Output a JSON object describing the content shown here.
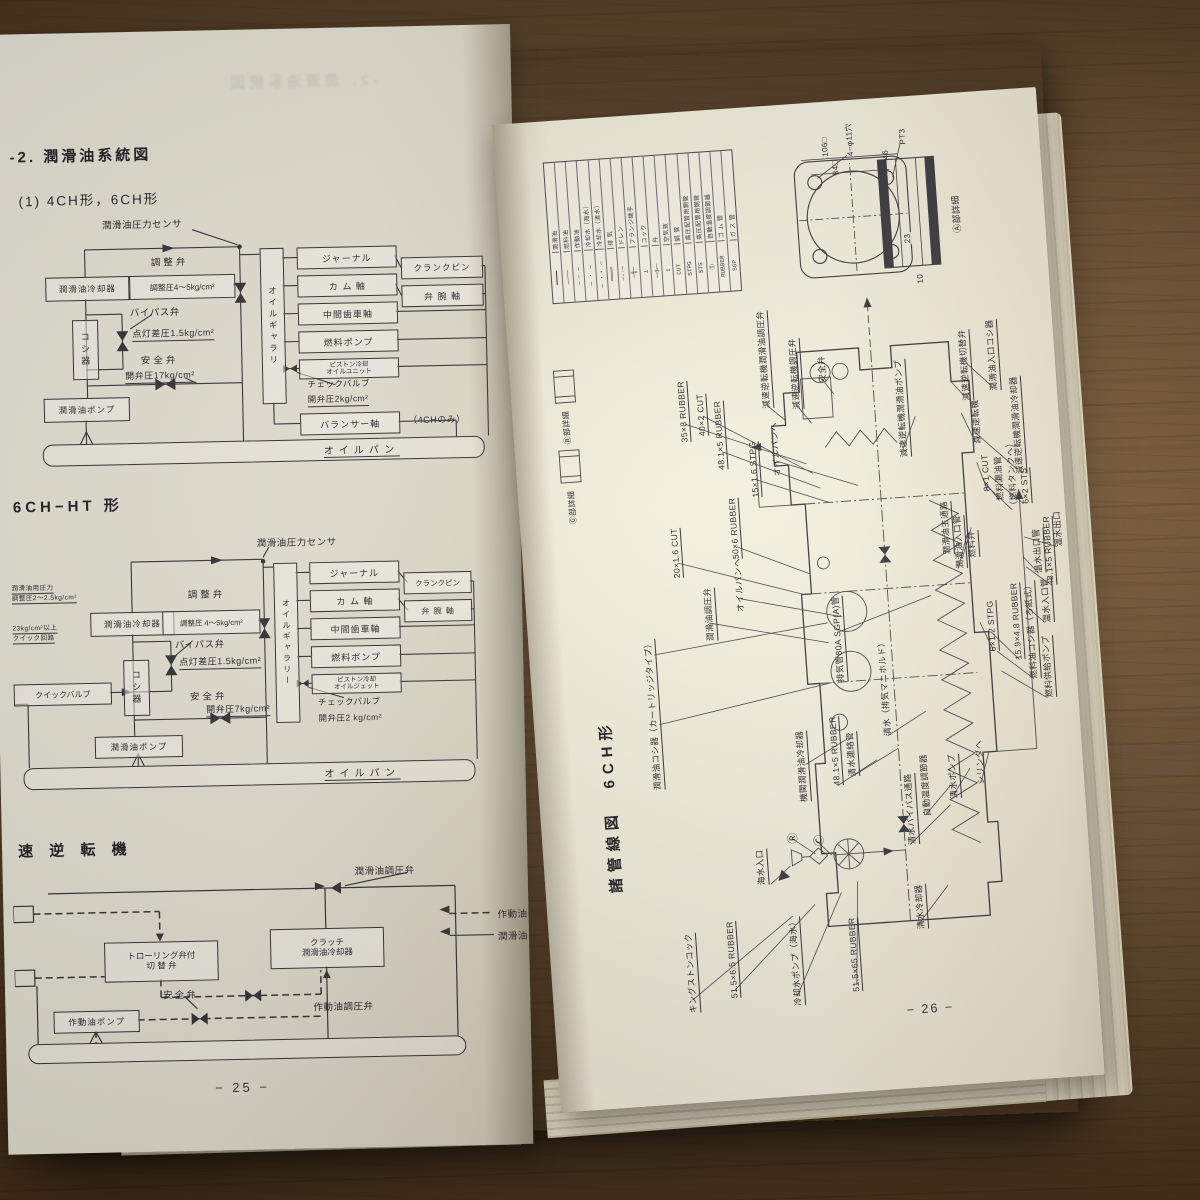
{
  "left_page": {
    "title": "-2. 潤滑油系統図",
    "subtitle": "(1) 4CH形，6CH形",
    "page_number": "− 25 −",
    "d1": {
      "sensor": "潤滑油圧力センサ",
      "cooler": "潤滑油冷却器",
      "reg_valve": "調整弁",
      "reg_pressure": "調整圧4〜5kg/cm²",
      "bypass": "バイパス弁",
      "strainer": "コシ器",
      "lamp_diff": "点灯差圧1.5kg/cm²",
      "safety": "安全弁",
      "open17": "開弁圧17kg/cm²",
      "pump": "潤滑油ポンプ",
      "gallery": "オイルギャラリ",
      "journal": "ジャーナル",
      "crankpin": "クランクピン",
      "cam": "カ ム 軸",
      "rocker": "弁 腕 軸",
      "idler": "中間歯車軸",
      "fuel_pump": "燃料ポンプ",
      "piston1": "ピストン冷却",
      "piston2": "オイルユニット",
      "check": "チェックバルブ",
      "open2": "開弁圧2kg/cm²",
      "balancer": "バランサー軸",
      "balancer_note": "（4CHのみ）",
      "pan": "オイルパン"
    },
    "d2_title": "6CH−HT 形",
    "d2": {
      "note1a": "潤滑油用圧力",
      "note1b": "調整圧2〜2.5kg/cm²",
      "note2a": "23kg/cm²以上",
      "note2b": "クイック回路",
      "quick_valve": "クイックバルブ",
      "sensor": "潤滑油圧力センサ",
      "cooler": "潤滑油冷却器",
      "reg_valve": "調整弁",
      "reg_pressure": "調整圧 4〜5kg/cm²",
      "bypass": "バイパス弁",
      "lamp_diff": "点灯差圧1.5kg/cm²",
      "strainer": "コシ器",
      "safety": "安全弁",
      "open7": "開弁圧7kg/cm²",
      "pump": "潤滑油ポンプ",
      "gallery": "オイルギャラリー",
      "journal": "ジャーナル",
      "crankpin": "クランクピン",
      "cam": "カ ム 軸",
      "rocker": "弁 腕 軸",
      "idler": "中間歯車軸",
      "fuel_pump": "燃料ポンプ",
      "piston1": "ピストン冷却",
      "piston2": "オイルジェット",
      "check": "チェックバルブ",
      "open2": "開弁圧2 kg/cm²",
      "pan": "オイルパン"
    },
    "d3_title": "速 逆 転 機",
    "d3": {
      "press_valve": "潤滑油調圧弁",
      "legend_working": "作動油",
      "legend_lube": "潤滑油",
      "trolling1": "トローリング弁付",
      "trolling2": "切 替 弁",
      "clutch1": "クラッチ",
      "clutch2": "潤滑油冷却器",
      "working_press_valve": "作動油調圧弁",
      "working_pump": "作動油ポンプ",
      "safety": "安全弁"
    }
  },
  "right_page": {
    "title": "諸管線図　6CH形",
    "page_number": "− 26 −",
    "legend": {
      "names": [
        "潤滑油",
        "燃料油",
        "作動油",
        "冷却水（海水）",
        "冷却水（清水）",
        "排 気",
        "ドレン",
        "フランジ継手",
        "コック",
        "弁",
        "空気抜",
        "銅 管",
        "高圧配管用鋼管",
        "高圧配管用鋼管",
        "自動温度調節器",
        "ゴ ム 管",
        "ガ ス 管"
      ],
      "symbols": [
        "━━━━",
        "────",
        "─ ─ ─",
        "─ ・ ─",
        "─ ・・ ─",
        "════",
        "─--─",
        "─╫─",
        "⊥",
        "─◁▷─",
        "↥",
        "CUT",
        "STPG",
        "STS",
        "Ⓣ",
        "RUBBER",
        "SGP"
      ]
    },
    "flange": {
      "dim106": "106□",
      "dim84": "84□",
      "dim46": "46",
      "dim23": "23",
      "dim10": "10",
      "thread": "PT3",
      "holes": "4−φ11穴",
      "detail_a": "Ⓐ部詳細",
      "detail_b": "Ⓑ部詳細",
      "detail_g": "Ⓖ部詳細"
    },
    "labels": [
      "35×8 RUBBER",
      "40×2 CUT",
      "48.1×5 RUBBER",
      "15×1.6 STPG",
      "オイルパンヘ",
      "20×1.6 CUT",
      "50×6 RUBBER",
      "潤滑油調圧弁",
      "オイルパンヘ",
      "潤滑油コシ器（カートリッジタイプ）",
      "排気管80A SGP(A)管",
      "潤滑油主通路",
      "潤滑油入口管",
      "6×1.2 STPG",
      "15.9×4.8 RUBBER",
      "燃料油コシ器（ろ紙式）",
      "燃料供給ポンプ",
      "燃料弁",
      "8×1 CUT",
      "燃料漏油管",
      "（燃料タンクヘ）",
      "6×2 STS",
      "温水出口管",
      "48.1×5 RUBBER",
      "温水出口",
      "機関潤滑油冷却器",
      "48.1×5 RUBBER",
      "清水連絡管",
      "清水（排気マニホルド）",
      "清水バイパス通路",
      "海水入口",
      "キングストンコック",
      "51.5×6.5 RUBBER",
      "冷却水ポンプ（海水）",
      "51.5×65 RUBBER",
      "清水ポンプ",
      "自動温度調節器",
      "シリンダヘ",
      "清水冷却器",
      "減速逆転機切替弁",
      "潤滑油入口コシ器",
      "減速逆転機",
      "減速逆転機潤滑油冷却器",
      "減速逆転機潤滑油調圧弁",
      "減速逆転機調圧弁",
      "安全弁",
      "減速逆転機潤滑油ポンプ",
      "Ⓡ",
      "Ⓒ",
      "温水入口管"
    ]
  }
}
